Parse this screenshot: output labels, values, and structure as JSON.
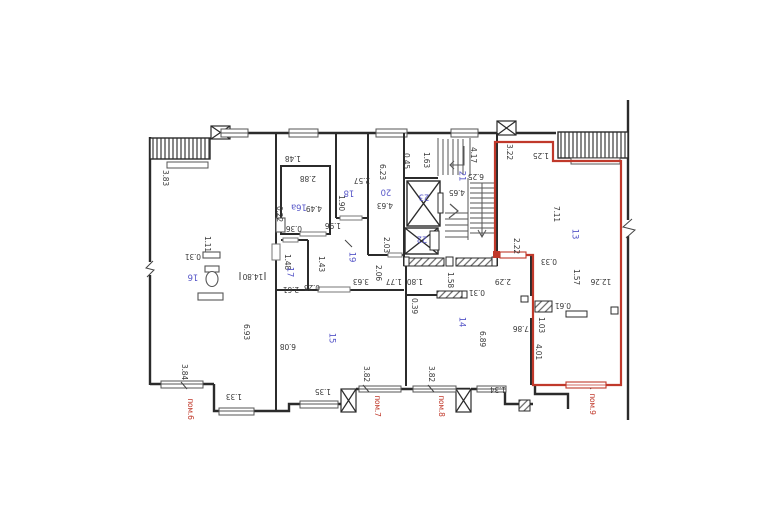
{
  "plan": {
    "type": "apartment-floor-plan",
    "colors": {
      "wall": "#2b2b2b",
      "dim_text": "#3a3a3a",
      "room_text": "#5757c8",
      "unit_outline": "#c0392b"
    },
    "highlighted_unit": "пом.9",
    "labels": [
      {
        "t": "3.83",
        "x": 165,
        "y": 178,
        "r": 90,
        "c": "dim"
      },
      {
        "t": "1.48",
        "x": 293,
        "y": 158,
        "r": 180,
        "c": "dim"
      },
      {
        "t": "1.11",
        "x": 207,
        "y": 244,
        "r": 90,
        "c": "dim"
      },
      {
        "t": "0.31",
        "x": 193,
        "y": 256,
        "r": 180,
        "c": "dim"
      },
      {
        "t": "14.80",
        "x": 253,
        "y": 276,
        "r": 180,
        "c": "dim"
      },
      {
        "t": "6.93",
        "x": 246,
        "y": 332,
        "r": 90,
        "c": "dim"
      },
      {
        "t": "3.84",
        "x": 184,
        "y": 372,
        "r": 90,
        "c": "dim"
      },
      {
        "t": "1.33",
        "x": 234,
        "y": 396,
        "r": 180,
        "c": "dim"
      },
      {
        "t": "6.08",
        "x": 288,
        "y": 346,
        "r": 180,
        "c": "dim"
      },
      {
        "t": "1.35",
        "x": 323,
        "y": 391,
        "r": 180,
        "c": "dim"
      },
      {
        "t": "3.82",
        "x": 366,
        "y": 374,
        "r": 90,
        "c": "dim"
      },
      {
        "t": "3.82",
        "x": 431,
        "y": 374,
        "r": 90,
        "c": "dim"
      },
      {
        "t": "1.34",
        "x": 498,
        "y": 389,
        "r": 180,
        "c": "dim"
      },
      {
        "t": "0.22",
        "x": 279,
        "y": 214,
        "r": 90,
        "c": "dim"
      },
      {
        "t": "2.88",
        "x": 308,
        "y": 178,
        "r": 180,
        "c": "dim"
      },
      {
        "t": "4.49",
        "x": 314,
        "y": 208,
        "r": 180,
        "c": "dim"
      },
      {
        "t": "0.36",
        "x": 294,
        "y": 228,
        "r": 180,
        "c": "dim"
      },
      {
        "t": "1.96",
        "x": 333,
        "y": 225,
        "r": 180,
        "c": "dim"
      },
      {
        "t": "1.48",
        "x": 287,
        "y": 262,
        "r": 90,
        "c": "dim"
      },
      {
        "t": "1.43",
        "x": 321,
        "y": 264,
        "r": 90,
        "c": "dim"
      },
      {
        "t": "2.61",
        "x": 291,
        "y": 289,
        "r": 180,
        "c": "dim"
      },
      {
        "t": "0.23",
        "x": 312,
        "y": 287,
        "r": 180,
        "c": "dim"
      },
      {
        "t": "2.57",
        "x": 362,
        "y": 180,
        "r": 180,
        "c": "dim"
      },
      {
        "t": "1.90",
        "x": 341,
        "y": 203,
        "r": 90,
        "c": "dim"
      },
      {
        "t": "6.23",
        "x": 382,
        "y": 172,
        "r": 90,
        "c": "dim"
      },
      {
        "t": "4.63",
        "x": 385,
        "y": 205,
        "r": 180,
        "c": "dim"
      },
      {
        "t": "2.03",
        "x": 386,
        "y": 245,
        "r": 90,
        "c": "dim"
      },
      {
        "t": "3.63",
        "x": 361,
        "y": 281,
        "r": 180,
        "c": "dim"
      },
      {
        "t": "2.06",
        "x": 378,
        "y": 273,
        "r": 90,
        "c": "dim"
      },
      {
        "t": "1.77",
        "x": 394,
        "y": 281,
        "r": 180,
        "c": "dim"
      },
      {
        "t": "0.45",
        "x": 406,
        "y": 161,
        "r": 90,
        "c": "dim"
      },
      {
        "t": "1.63",
        "x": 426,
        "y": 160,
        "r": 90,
        "c": "dim"
      },
      {
        "t": "4.17",
        "x": 473,
        "y": 155,
        "r": 90,
        "c": "dim"
      },
      {
        "t": "6.25",
        "x": 476,
        "y": 176,
        "r": 180,
        "c": "dim"
      },
      {
        "t": "4.65",
        "x": 457,
        "y": 192,
        "r": 180,
        "c": "dim"
      },
      {
        "t": "1.80",
        "x": 415,
        "y": 281,
        "r": 180,
        "c": "dim"
      },
      {
        "t": "1.58",
        "x": 450,
        "y": 280,
        "r": 90,
        "c": "dim"
      },
      {
        "t": "0.31",
        "x": 477,
        "y": 292,
        "r": 180,
        "c": "dim"
      },
      {
        "t": "0.39",
        "x": 414,
        "y": 306,
        "r": 90,
        "c": "dim"
      },
      {
        "t": "6.89",
        "x": 482,
        "y": 339,
        "r": 90,
        "c": "dim"
      },
      {
        "t": "7.86",
        "x": 521,
        "y": 328,
        "r": 180,
        "c": "dim"
      },
      {
        "t": "2.22",
        "x": 516,
        "y": 246,
        "r": 90,
        "c": "dim"
      },
      {
        "t": "3.22",
        "x": 509,
        "y": 152,
        "r": 90,
        "c": "dim"
      },
      {
        "t": "1.25",
        "x": 541,
        "y": 155,
        "r": 180,
        "c": "dim"
      },
      {
        "t": "7.11",
        "x": 556,
        "y": 214,
        "r": 90,
        "c": "dim"
      },
      {
        "t": "0.33",
        "x": 549,
        "y": 261,
        "r": 180,
        "c": "dim"
      },
      {
        "t": "2.29",
        "x": 503,
        "y": 281,
        "r": 180,
        "c": "dim"
      },
      {
        "t": "1.57",
        "x": 576,
        "y": 277,
        "r": 90,
        "c": "dim"
      },
      {
        "t": "12.26",
        "x": 601,
        "y": 281,
        "r": 180,
        "c": "dim"
      },
      {
        "t": "0.61",
        "x": 563,
        "y": 305,
        "r": 180,
        "c": "dim"
      },
      {
        "t": "1.03",
        "x": 541,
        "y": 325,
        "r": 90,
        "c": "dim"
      },
      {
        "t": "4.01",
        "x": 538,
        "y": 352,
        "r": 90,
        "c": "dim"
      },
      {
        "t": "16",
        "x": 193,
        "y": 276,
        "r": 180,
        "c": "room"
      },
      {
        "t": "16а",
        "x": 299,
        "y": 206,
        "r": 180,
        "c": "room"
      },
      {
        "t": "17",
        "x": 289,
        "y": 272,
        "r": 90,
        "c": "room"
      },
      {
        "t": "18",
        "x": 349,
        "y": 192,
        "r": 180,
        "c": "room"
      },
      {
        "t": "19",
        "x": 351,
        "y": 257,
        "r": 90,
        "c": "room"
      },
      {
        "t": "20",
        "x": 386,
        "y": 191,
        "r": 180,
        "c": "room"
      },
      {
        "t": "21",
        "x": 461,
        "y": 176,
        "r": 90,
        "c": "room"
      },
      {
        "t": "22",
        "x": 422,
        "y": 238,
        "r": 180,
        "c": "room"
      },
      {
        "t": "23",
        "x": 424,
        "y": 196,
        "r": 180,
        "c": "room"
      },
      {
        "t": "15",
        "x": 331,
        "y": 338,
        "r": 90,
        "c": "room"
      },
      {
        "t": "14",
        "x": 461,
        "y": 322,
        "r": 90,
        "c": "room"
      },
      {
        "t": "13",
        "x": 574,
        "y": 234,
        "r": 90,
        "c": "room"
      },
      {
        "t": "пом.6",
        "x": 190,
        "y": 409,
        "r": 90,
        "c": "unit"
      },
      {
        "t": "пом.7",
        "x": 377,
        "y": 406,
        "r": 90,
        "c": "unit"
      },
      {
        "t": "пом.8",
        "x": 441,
        "y": 406,
        "r": 90,
        "c": "unit"
      },
      {
        "t": "пом.9",
        "x": 592,
        "y": 404,
        "r": 90,
        "c": "unit"
      }
    ]
  }
}
